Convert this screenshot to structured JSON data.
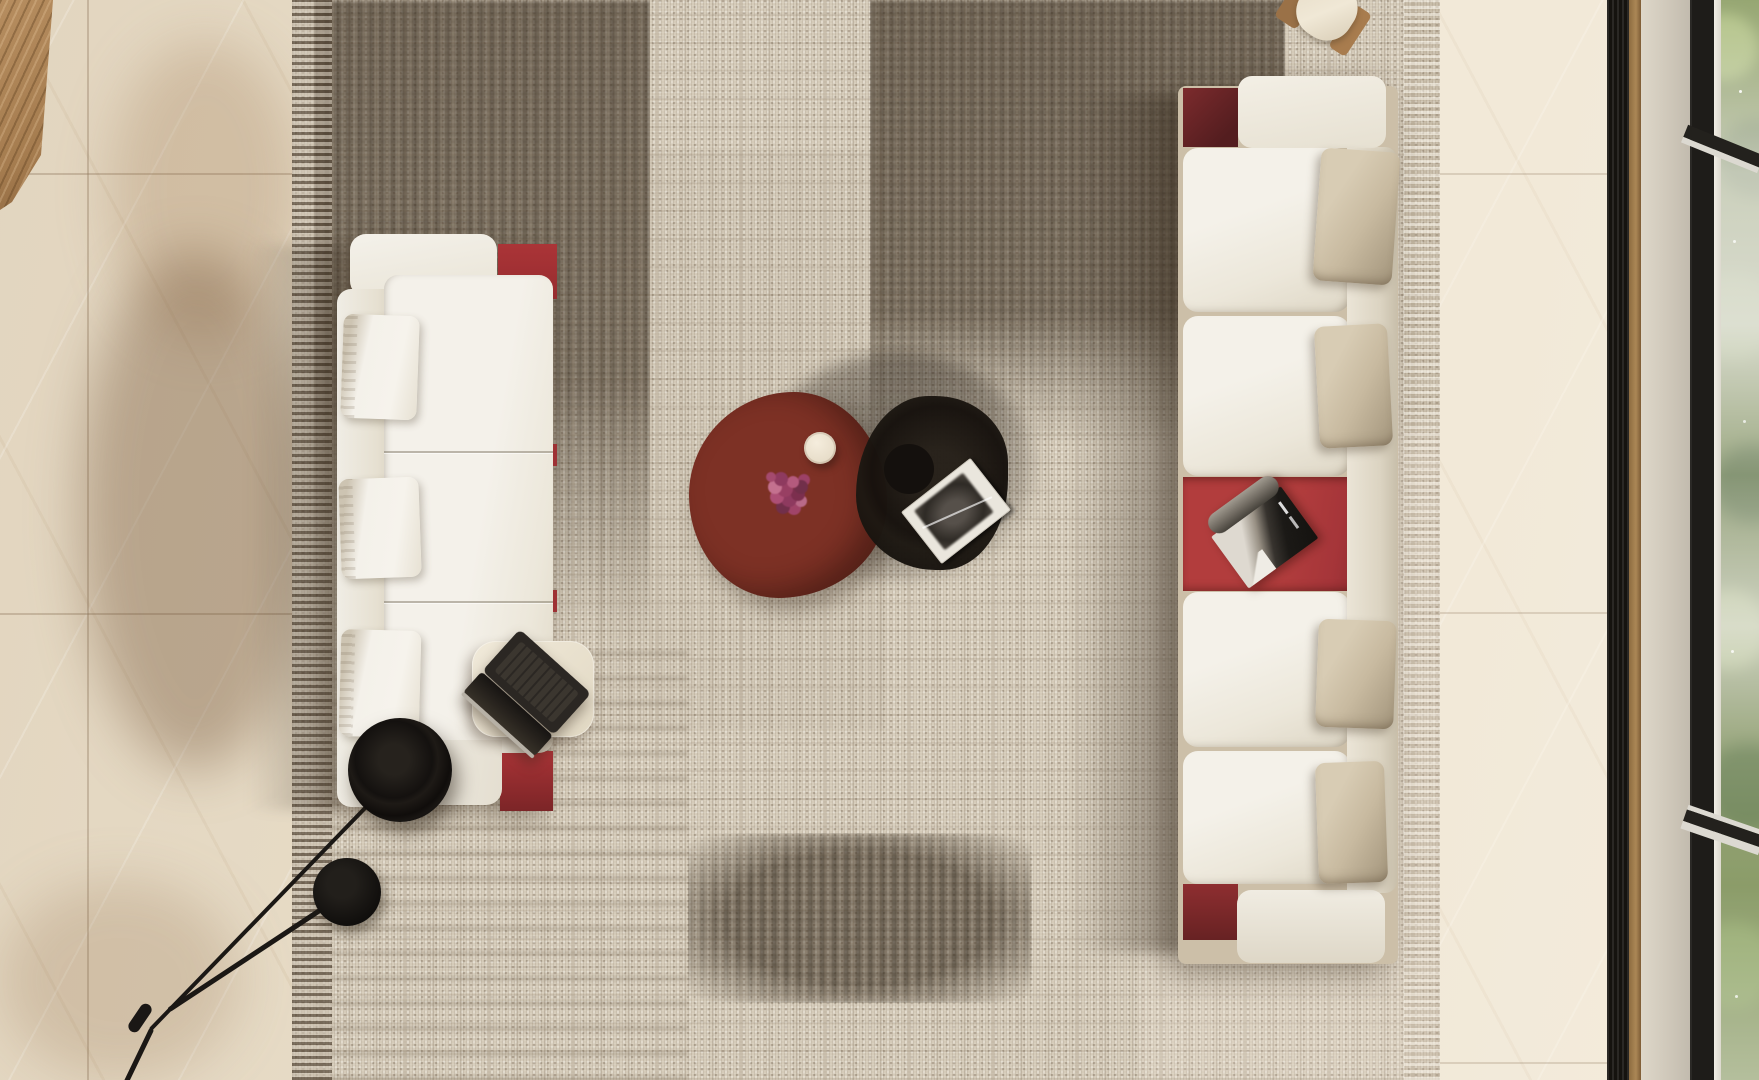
{
  "scene": {
    "description": "Top-down 3D interior render of a modern lounge seating area",
    "view": "bird's-eye",
    "room": "living lounge with two facing modular sofas on a patchwork tweed rug"
  },
  "palette": {
    "tile_floor": "#e8ddc8",
    "wood_counter": "#a57c4f",
    "rug_light": "#d5cbb9",
    "rug_dark_patch": "#5f5240",
    "sofa_white": "#f2efe7",
    "accent_red": "#ab3437",
    "accent_maroon": "#6b2425",
    "tray_red": "#b23d3d",
    "pillow_greige": "#c8baa0",
    "marble_table_red": "#7d3125",
    "black_elements": "#15110e",
    "window_frame": "#1e1c19",
    "mullion_white": "#eceae2",
    "foliage_green": "#6d8148",
    "sill_wood": "#a28050"
  },
  "objects": {
    "rug": {
      "style": "patchwork plaid tweed",
      "colors": [
        "#d5cbb9",
        "#5f5240",
        "#8a7a66"
      ]
    },
    "left_sofa": {
      "upholstery": "white boucle",
      "base": "red lacquer platform",
      "pillows": 3,
      "orientation": "back to the west"
    },
    "right_sofa": {
      "upholstery": "ivory boucle",
      "base": "red lacquer platform",
      "seats": 4,
      "back_pillows": 4,
      "integrated_tray": "red lacquer with magazine",
      "orientation": "back to the east"
    },
    "coffee_table": {
      "material": "red marble",
      "shape": "organic round",
      "items": [
        "white candle",
        "magenta flowers"
      ]
    },
    "side_table_black": {
      "material": "smoked glass / black",
      "shape": "organic round",
      "items": [
        "open art book"
      ]
    },
    "laptop_table": {
      "material": "cream stone",
      "shape": "rounded square"
    },
    "laptop": {
      "state": "open",
      "color": "black with silver hinge"
    },
    "floor_lamp": {
      "type": "counterweight arm lamp",
      "shade": "large black disc",
      "counterweight": "small black disc"
    },
    "reading_lamp_top": {
      "shade": "cream cylinder",
      "arm": "wood"
    },
    "wood_counter": {
      "position": "top-left corner",
      "finish": "oak"
    },
    "window": {
      "frame": "black steel",
      "mullions": "white",
      "view": "green foliage with fog",
      "sill": "wood strip"
    }
  },
  "counts": {
    "sofas": 2,
    "tables": 3,
    "lamps": 2,
    "pillows_total": 7
  }
}
